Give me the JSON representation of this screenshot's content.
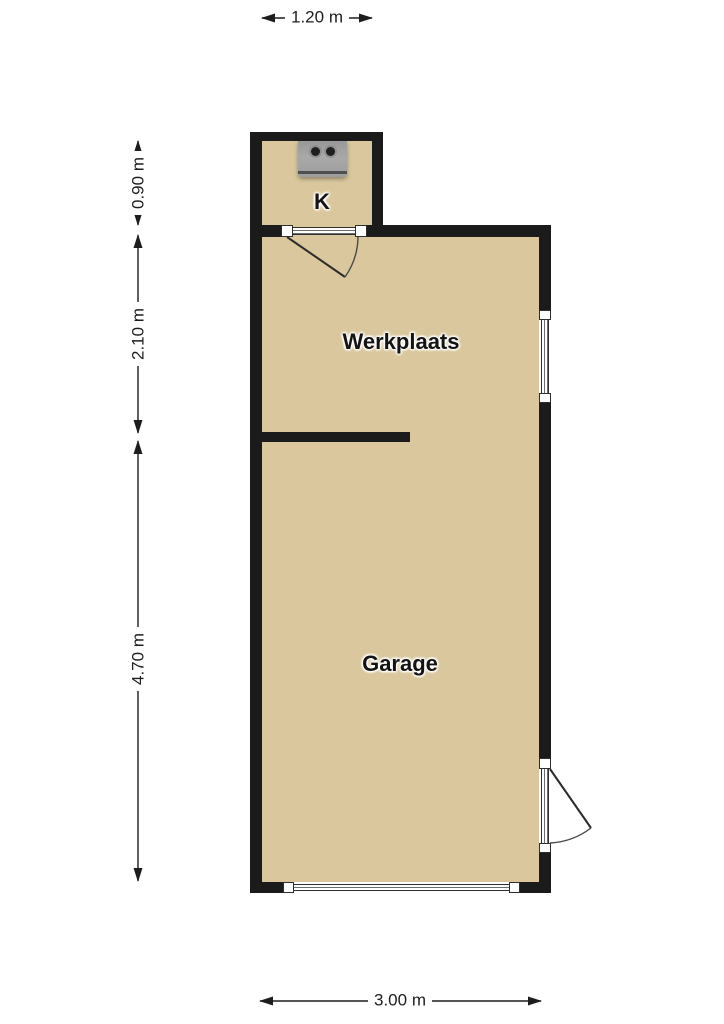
{
  "rooms": [
    {
      "id": "k",
      "label": "K"
    },
    {
      "id": "werkplaats",
      "label": "Werkplaats"
    },
    {
      "id": "garage",
      "label": "Garage"
    }
  ],
  "dimensions": {
    "top_width": "1.20 m",
    "k_height": "0.90 m",
    "werkplaats_height": "2.10 m",
    "garage_height": "4.70 m",
    "bottom_width": "3.00 m"
  },
  "fixtures": [
    {
      "id": "stove",
      "name": "stove-icon",
      "burners": 2
    }
  ],
  "colors": {
    "floor": "#dac79d",
    "wall": "#1b1b1b",
    "text": "#1d1d1d",
    "symbol-line": "#2f2f2f"
  }
}
